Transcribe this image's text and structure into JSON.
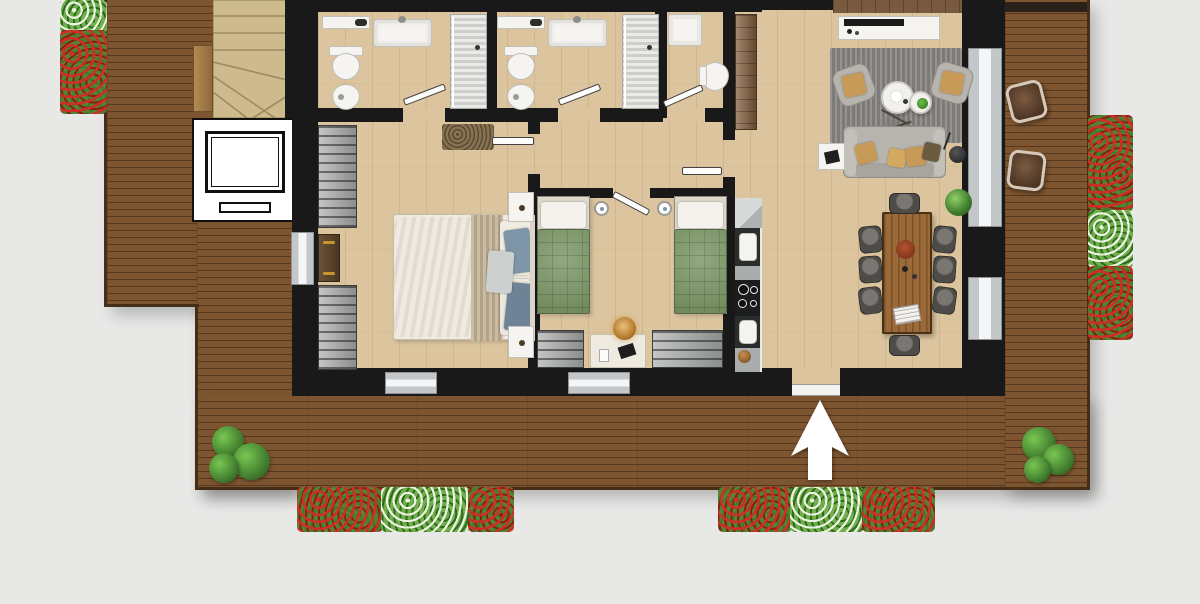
{
  "scene": {
    "type": "architectural-floor-plan-render",
    "view": "top-down",
    "background_color": "#e8e8e7",
    "palette": {
      "bg": "#e8e8e7",
      "wall": "#191919",
      "floor": "#dcc59e",
      "deck": "#7d5530",
      "deck_line": "#58391d",
      "deck_border": "#452e16",
      "stairs": "#cdbb8e",
      "stair_line": "#9d8a5f",
      "white": "#f5f4f1",
      "window": "#c3c7ca",
      "shower": "#d8d9d4",
      "steel": "#a9adac",
      "dark": "#2b2c2c",
      "wardrobe": "#a3a7a5",
      "cabinet": "#85603f",
      "shelf": "#7a5a3e",
      "rug": "#8e8c89",
      "sofa": "#b7b4ae",
      "cushion": "#c89a57",
      "linen": "#e4ded1",
      "stripe": "#bfb298",
      "blue": "#7e95a8",
      "green_bed": "#7d9a68",
      "table": "#9c6a39",
      "chair": "#4e4c49",
      "plant": "#3f7a2c",
      "flower_red": "#cc2f27",
      "flower_light": "#e9f3df",
      "amber": "#b67b2e",
      "mat": "#877253",
      "arrow": "#ffffff"
    },
    "areas": [
      {
        "id": "stairwell"
      },
      {
        "id": "elevator"
      },
      {
        "id": "bathroom-1"
      },
      {
        "id": "bathroom-2"
      },
      {
        "id": "wc"
      },
      {
        "id": "master-bedroom"
      },
      {
        "id": "twin-bedroom"
      },
      {
        "id": "hallway"
      },
      {
        "id": "kitchen"
      },
      {
        "id": "living-room"
      },
      {
        "id": "dining-area"
      },
      {
        "id": "wraparound-deck"
      }
    ],
    "furniture_counts": {
      "double_beds": 1,
      "single_beds": 2,
      "toilets": 3,
      "bidets": 2,
      "showers": 3,
      "sink_vanities": 3,
      "wardrobes": 5,
      "dining_chairs": 8,
      "armchairs": 2,
      "sofas": 1,
      "outdoor_stools": 2,
      "flower_planters": 4,
      "bushes": 2
    },
    "entrance": {
      "indicator": "white-up-arrow",
      "location": "bottom-center-deck"
    }
  }
}
